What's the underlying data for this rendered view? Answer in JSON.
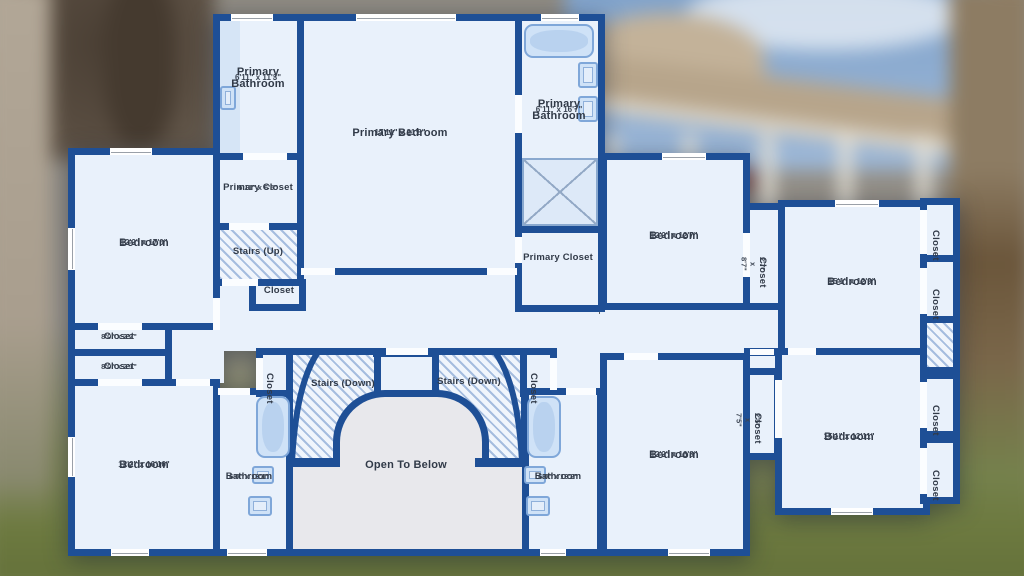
{
  "colors": {
    "wall": "#1e4f96",
    "floor": "#e9f1fb",
    "fixture": "#cfe2f7",
    "fixborder": "#7fa7d9",
    "open": "#e8e8ec",
    "text": "#313a48"
  },
  "rooms": {
    "primary_bathroom_1": {
      "name": "Primary Bathroom",
      "dims": "6'11\" x 11'3\""
    },
    "primary_bedroom": {
      "name": "Primary Bedroom",
      "dims": "17'11\" x 21'8\""
    },
    "primary_bathroom_2": {
      "name": "Primary Bathroom",
      "dims": "6'11\" x 16'7\""
    },
    "primary_closet_1": {
      "name": "Primary Closet",
      "dims": "6'11\" x 6'5\""
    },
    "stairs_up": {
      "name": "Stairs (Up)"
    },
    "closet_stairs": {
      "name": "Closet"
    },
    "primary_closet_2": {
      "name": "Primary Closet"
    },
    "bedroom_nw": {
      "name": "Bedroom",
      "dims": "12'2\" x 17'0\""
    },
    "closet_w1": {
      "name": "Closet",
      "dims": "8'0\" x 2'2\""
    },
    "closet_w2": {
      "name": "Closet",
      "dims": "8'0\" x 2'1\""
    },
    "bedroom_sw": {
      "name": "Bedroom",
      "dims": "12'2\" x 16'10\""
    },
    "bathroom_w": {
      "name": "Bathroom",
      "dims": "6'0\" x 13'1\""
    },
    "closet_hall_w": {
      "name": "Closet"
    },
    "stairs_down_w": {
      "name": "Stairs (Down)"
    },
    "stairs_down_e": {
      "name": "Stairs (Down)"
    },
    "closet_hall_e": {
      "name": "Closet"
    },
    "open_to_below": {
      "name": "Open To Below"
    },
    "bathroom_e": {
      "name": "Bathroom",
      "dims": "6'0\" x 13'2\""
    },
    "bedroom_c_n": {
      "name": "Bedroom",
      "dims": "12'2\" x 12'7\""
    },
    "closet_c_n": {
      "name": "Closet",
      "dims": "2'7\" x 8'7\""
    },
    "bedroom_c_s": {
      "name": "Bedroom",
      "dims": "12'2\" x 16'8\""
    },
    "closet_c_s": {
      "name": "Closet",
      "dims": "2'5\" x 7'5\""
    },
    "bedroom_e_n": {
      "name": "Bedroom",
      "dims": "15'1\" x 12'9\""
    },
    "bedroom_e_s": {
      "name": "Bedroom",
      "dims": "15'1\" x 12'11\""
    },
    "closet_e1": {
      "name": "Closet"
    },
    "closet_e2": {
      "name": "Closet"
    },
    "closet_e3": {
      "name": "Closet"
    },
    "closet_e4": {
      "name": "Closet"
    }
  }
}
